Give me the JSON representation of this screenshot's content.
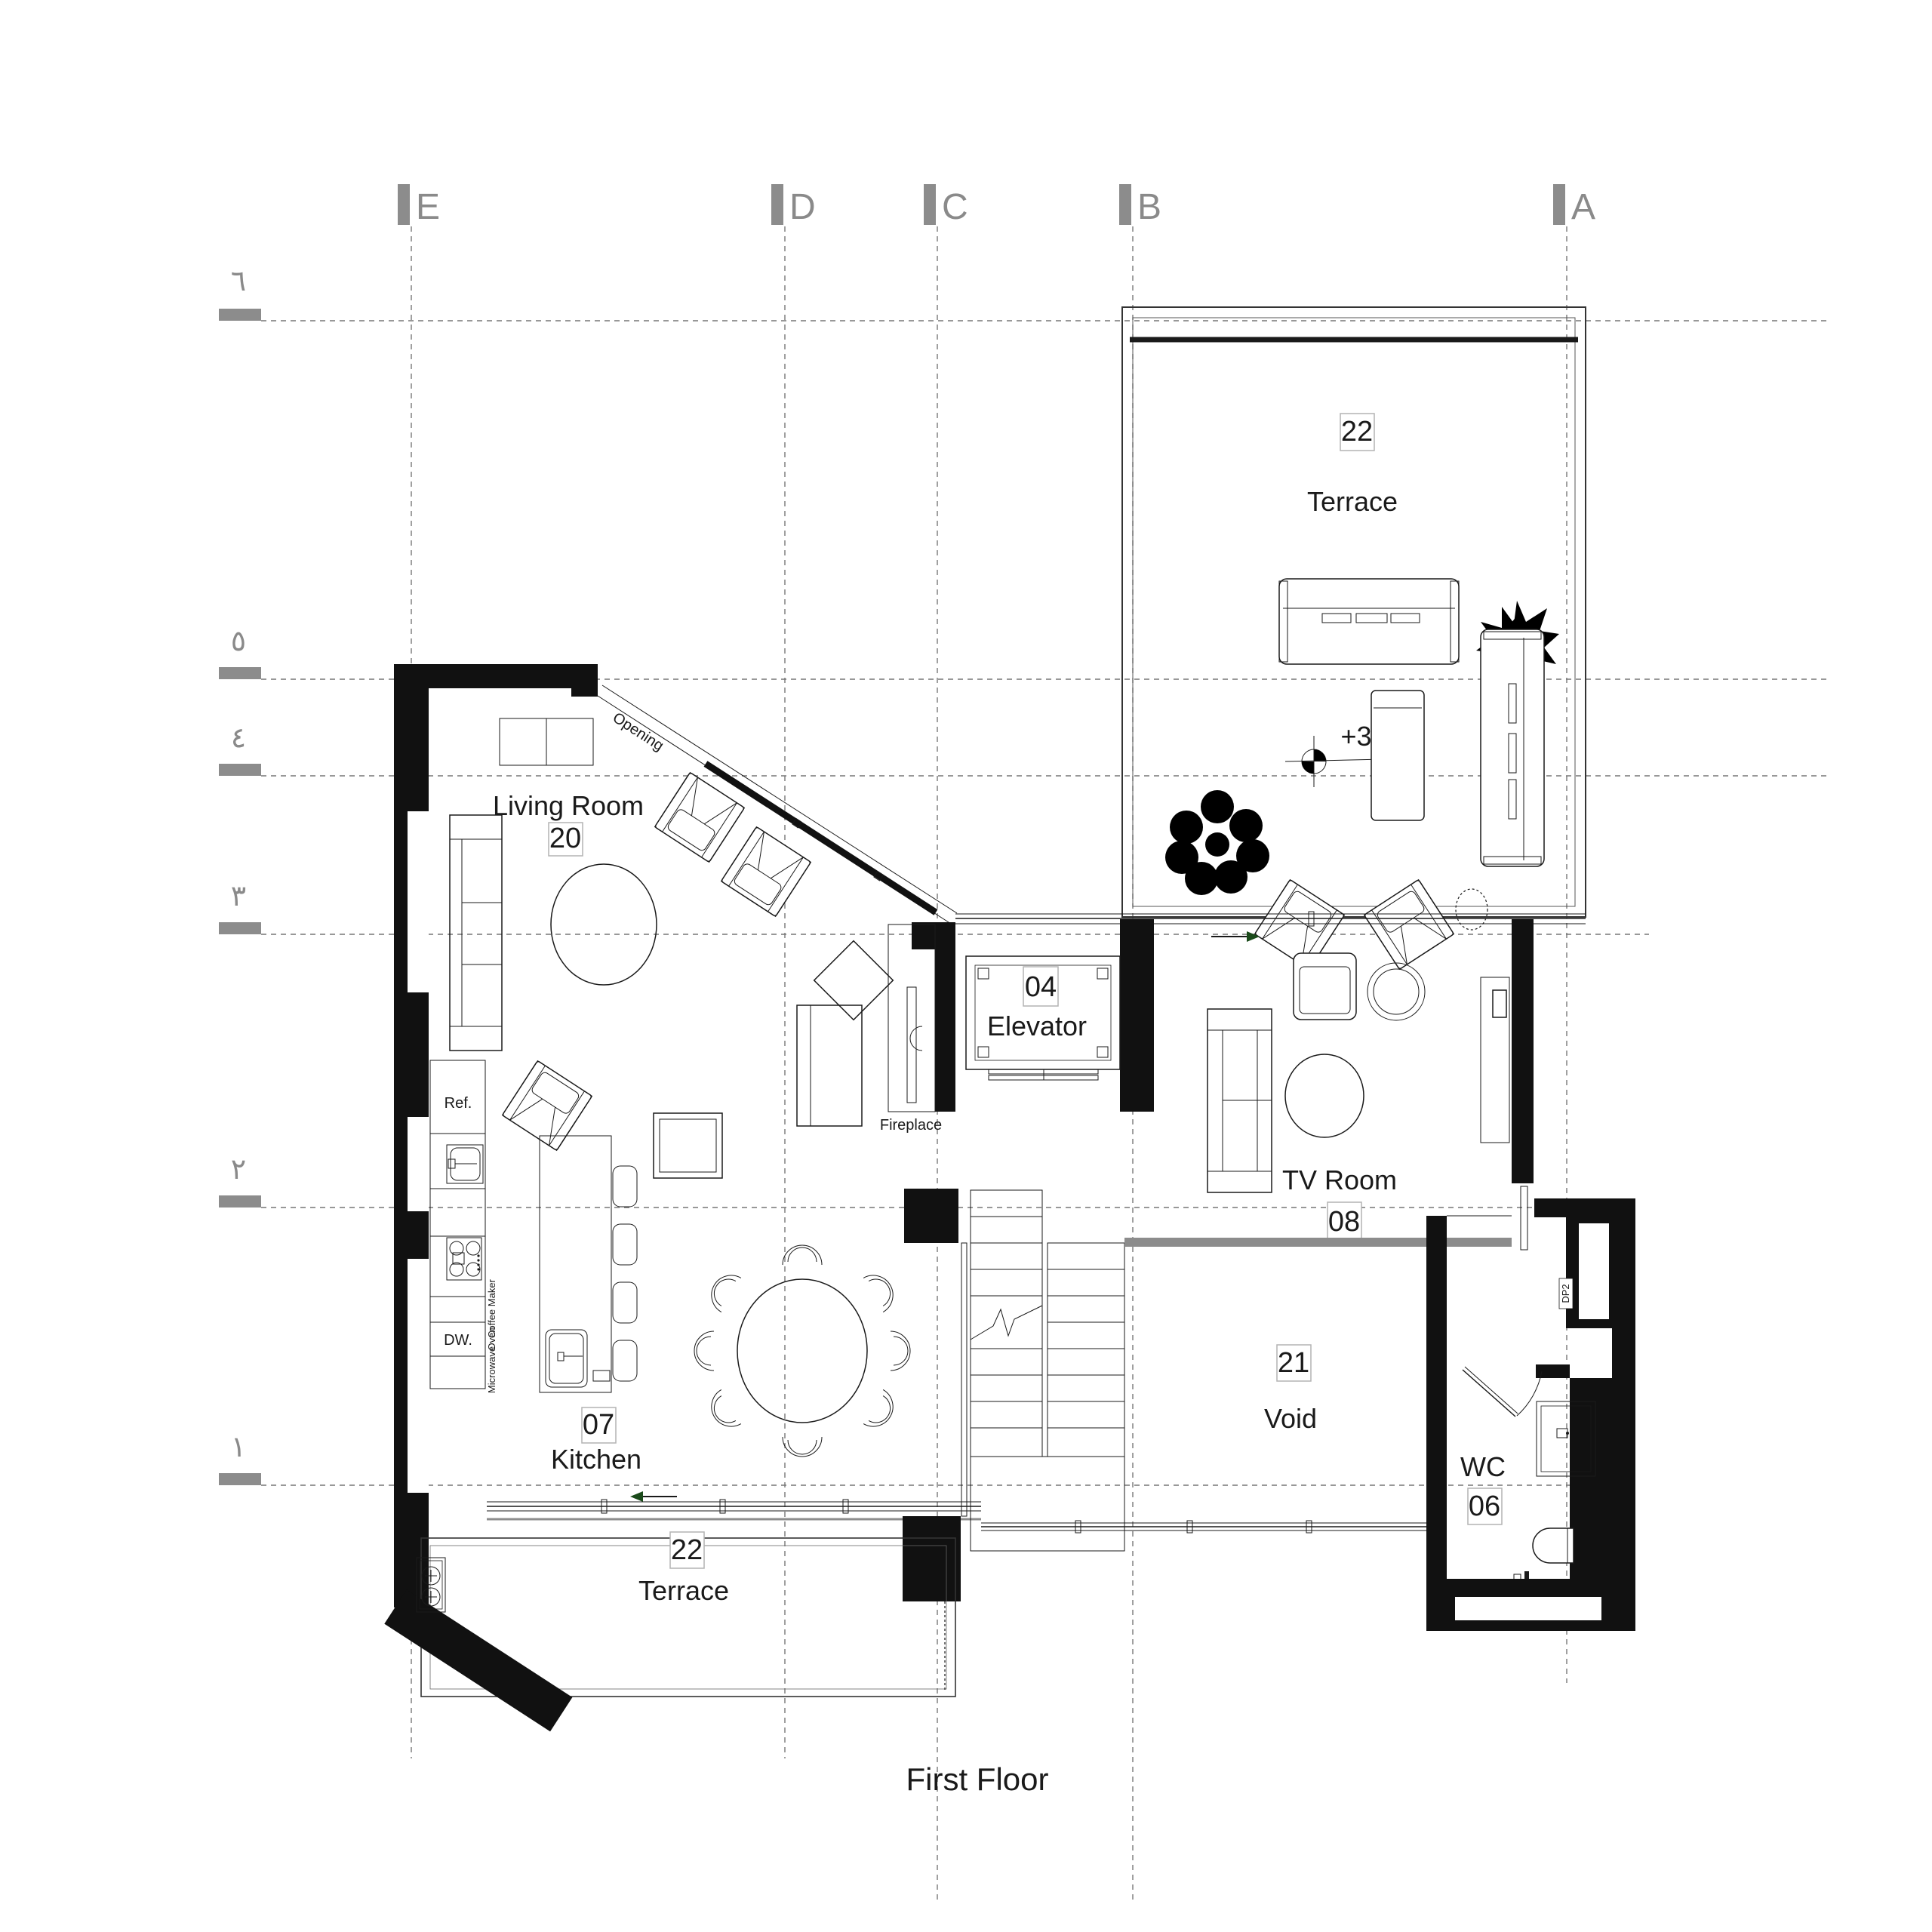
{
  "title": "First Floor",
  "grid": {
    "columns": [
      {
        "label": "E"
      },
      {
        "label": "D"
      },
      {
        "label": "C"
      },
      {
        "label": "B"
      },
      {
        "label": "A"
      }
    ],
    "rows": [
      {
        "label": "٦"
      },
      {
        "label": "٥"
      },
      {
        "label": "٤"
      },
      {
        "label": "٣"
      },
      {
        "label": "٢"
      },
      {
        "label": "١"
      }
    ]
  },
  "rooms": {
    "terrace_upper": {
      "number": "22",
      "name": "Terrace"
    },
    "living_room": {
      "number": "20",
      "name": "Living Room"
    },
    "elevator": {
      "number": "04",
      "name": "Elevator"
    },
    "tv_room": {
      "number": "08",
      "name": "TV Room"
    },
    "kitchen": {
      "number": "07",
      "name": "Kitchen"
    },
    "void": {
      "number": "21",
      "name": "Void"
    },
    "wc": {
      "number": "06",
      "name": "WC"
    },
    "terrace_lower": {
      "number": "22",
      "name": "Terrace"
    }
  },
  "annotations": {
    "level": "+3.77",
    "opening": "Opening",
    "fireplace": "Fireplace",
    "door_tag": "DP2"
  },
  "appliances": {
    "fridge": "Ref.",
    "dishwasher": "DW.",
    "coffee_maker": "Coffee Maker",
    "oven": "Oven",
    "microwave": "Microwave"
  }
}
